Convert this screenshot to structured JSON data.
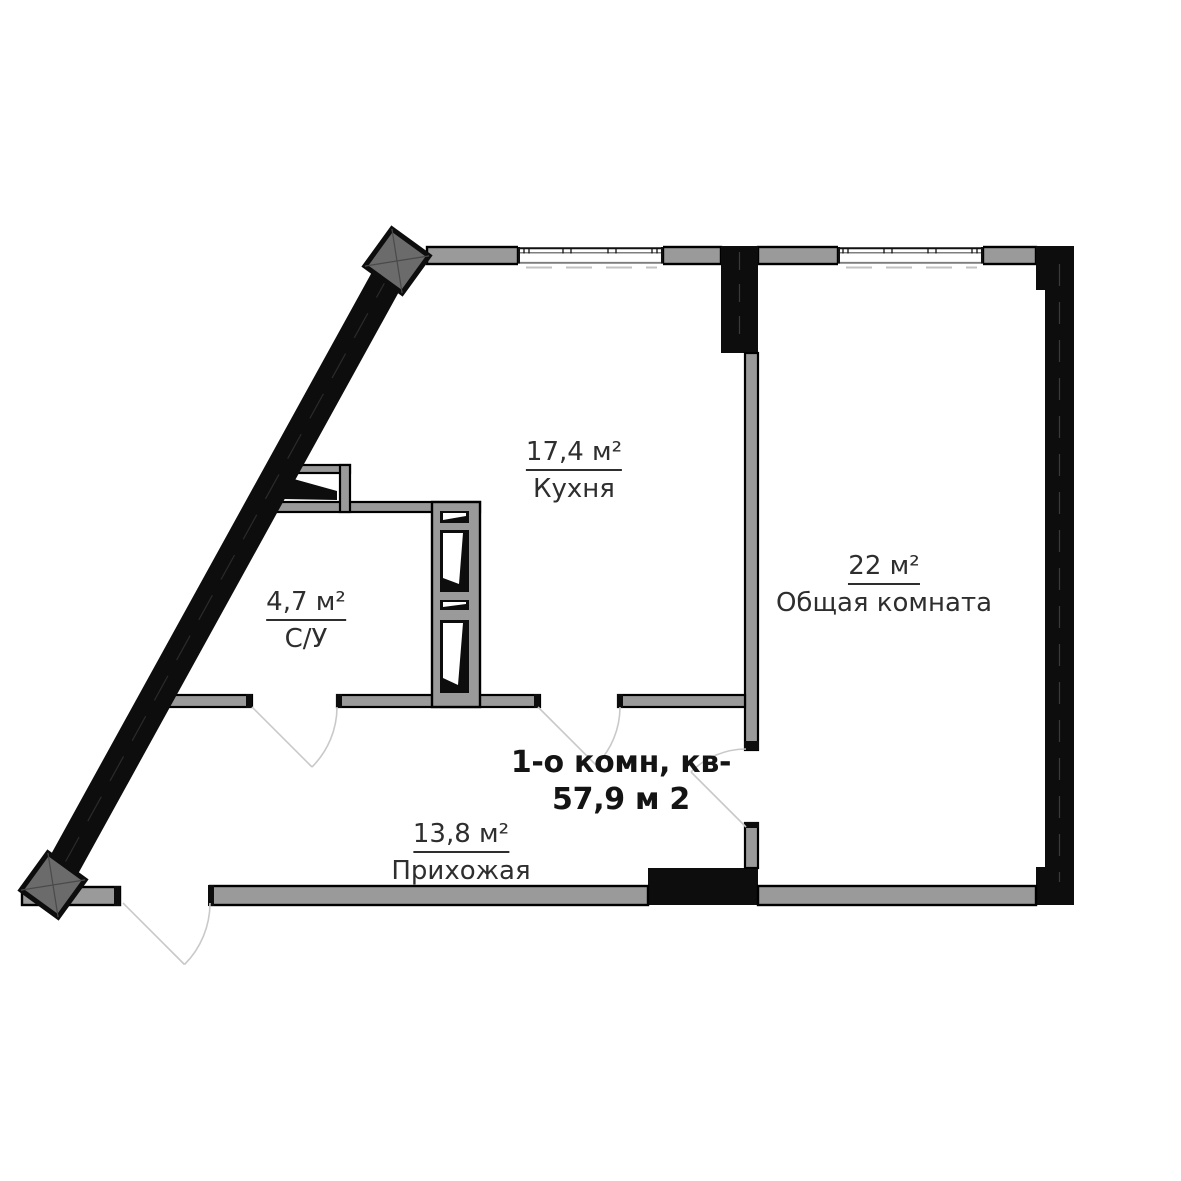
{
  "plan": {
    "title_line1": "1-о комн, кв-",
    "title_line2": "57,9 м 2",
    "rooms": [
      {
        "area": "17,4 м²",
        "name": "Кухня"
      },
      {
        "area": "4,7 м²",
        "name": "С/У"
      },
      {
        "area": "22 м²",
        "name": "Общая комната"
      },
      {
        "area": "13,8 м²",
        "name": "Прихожая"
      }
    ],
    "colors": {
      "background": "#ffffff",
      "wall_fill": "#9a9a9a",
      "wall_outline": "#000000",
      "structure_black": "#0d0d0d",
      "column_fill": "#6b6b6b",
      "label_text": "#2e2e2e",
      "title_text": "#141414",
      "door_arc": "#c9c9c9"
    }
  }
}
